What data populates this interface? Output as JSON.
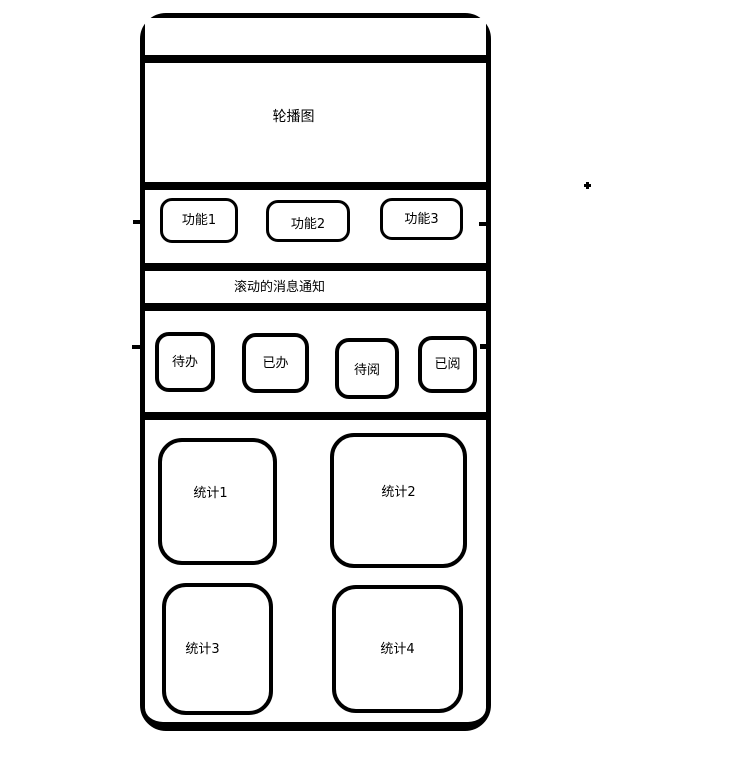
{
  "page": {
    "background": "#ffffff",
    "ink_color": "#000000"
  },
  "wireframe": {
    "carousel": {
      "label": "轮播图"
    },
    "function_buttons": [
      {
        "label": "功能1"
      },
      {
        "label": "功能2"
      },
      {
        "label": "功能3"
      }
    ],
    "notice": {
      "label": "滚动的消息通知"
    },
    "todo_tabs": [
      {
        "label": "待办"
      },
      {
        "label": "已办"
      },
      {
        "label": "待阅"
      },
      {
        "label": "已阅"
      }
    ],
    "stat_cards": [
      {
        "label": "统计1"
      },
      {
        "label": "统计2"
      },
      {
        "label": "统计3"
      },
      {
        "label": "统计4"
      }
    ]
  }
}
